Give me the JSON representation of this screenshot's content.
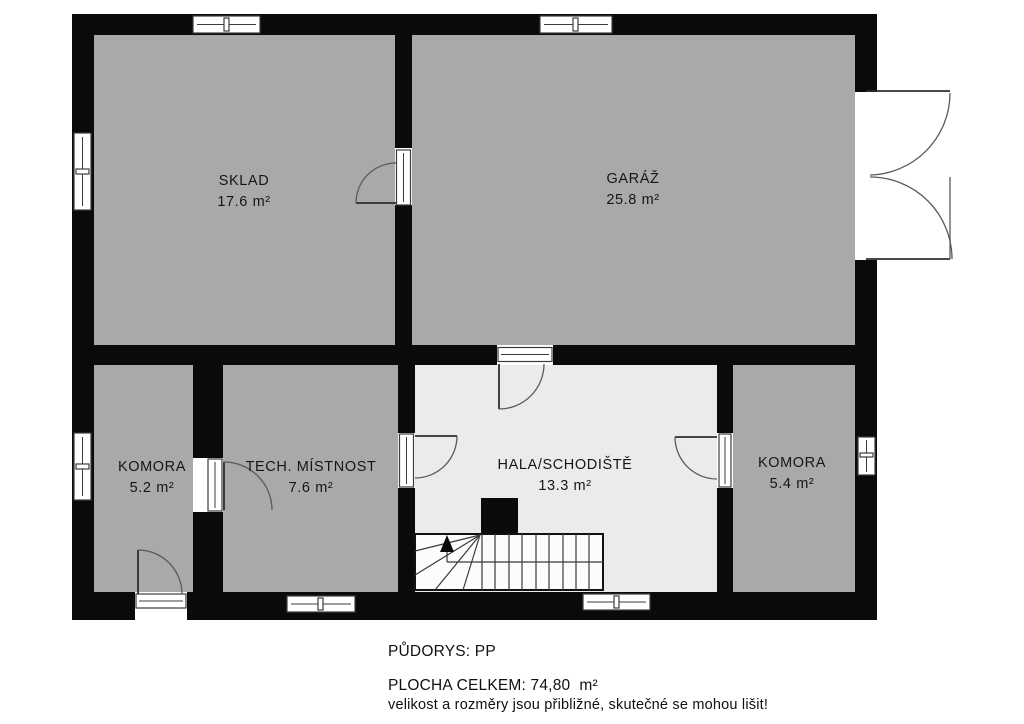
{
  "plan": {
    "rooms": [
      {
        "id": "sklad",
        "name": "SKLAD",
        "area": "17.6 m²"
      },
      {
        "id": "garaz",
        "name": "GARÁŽ",
        "area": "25.8 m²"
      },
      {
        "id": "komora-left",
        "name": "KOMORA",
        "area": "5.2 m²"
      },
      {
        "id": "tech-mistnost",
        "name": "TECH. MÍSTNOST",
        "area": "7.6 m²"
      },
      {
        "id": "hala",
        "name": "HALA/SCHODIŠTĚ",
        "area": "13.3 m²"
      },
      {
        "id": "komora-right",
        "name": "KOMORA",
        "area": "5.4 m²"
      }
    ],
    "footer": {
      "title": "PŮDORYS: PP",
      "total": "PLOCHA CELKEM: 74,80  m²",
      "disclaimer": "velikost a rozměry jsou přibližné, skutečné se mohou lišit!"
    },
    "colors": {
      "wall": "#0a0a0a",
      "room_fill": "#a9a9a9",
      "hall_fill": "#ebebeb",
      "background": "#ffffff",
      "line": "#3c3c3c"
    }
  }
}
